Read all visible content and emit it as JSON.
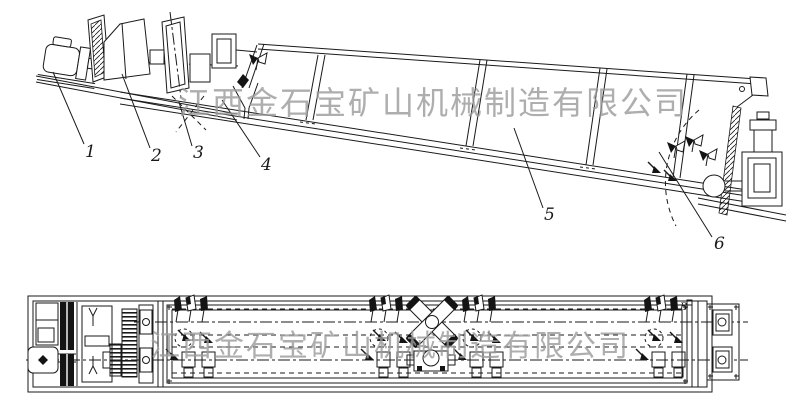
{
  "watermark": {
    "text": "江西金石宝矿山机械制造有限公司"
  },
  "views": {
    "side": {
      "labels": [
        "1",
        "2",
        "3",
        "4",
        "5",
        "6"
      ]
    },
    "plan": {
      "detail_marker": "B"
    }
  },
  "colors": {
    "line": "#1a1a1a",
    "watermark": "#9a9a9a",
    "background": "#ffffff"
  }
}
